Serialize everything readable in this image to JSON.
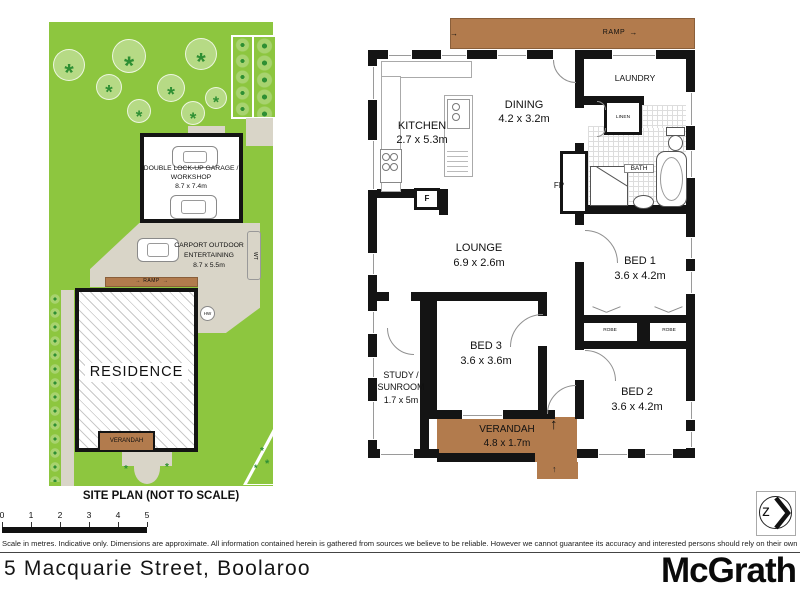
{
  "site_plan": {
    "title": "SITE PLAN (NOT TO SCALE)",
    "garage_label_1": "DOUBLE LOCK-UP GARAGE /",
    "garage_label_2": "WORKSHOP",
    "garage_dims": "8.7 x 7.4m",
    "carport_label_1": "CARPORT OUTDOOR",
    "carport_label_2": "ENTERTAINING",
    "carport_dims": "8.7 x 5.5m",
    "residence": "RESIDENCE",
    "verandah": "VERANDAH",
    "ramp": "RAMP",
    "water_tank": "WT",
    "hot_water": "HW"
  },
  "floor_plan": {
    "ramp": "RAMP",
    "kitchen_name": "KITCHEN",
    "kitchen_dims": "2.7 x 5.3m",
    "dining_name": "DINING",
    "dining_dims": "4.2 x 3.2m",
    "laundry": "LAUNDRY",
    "linen": "LINEN",
    "bath": "BATH",
    "fireplace": "FP",
    "fridge": "F",
    "lounge_name": "LOUNGE",
    "lounge_dims": "6.9 x 2.6m",
    "bed1_name": "BED 1",
    "bed1_dims": "3.6 x 4.2m",
    "bed2_name": "BED 2",
    "bed2_dims": "3.6 x 4.2m",
    "bed3_name": "BED 3",
    "bed3_dims": "3.6 x 3.6m",
    "study_line1": "STUDY /",
    "study_line2": "SUNROOM",
    "study_dims": "1.7 x 5m",
    "robe_left": "ROBE",
    "robe_right": "ROBE",
    "verandah_name": "VERANDAH",
    "verandah_dims": "4.8 x 1.7m"
  },
  "icons": {
    "arrow_right": "→",
    "arrow_up": "↑",
    "compass_letter": "z"
  },
  "footer": {
    "scale_ticks": [
      "0",
      "1",
      "2",
      "3",
      "4",
      "5"
    ],
    "disclaimer": "Scale in metres. Indicative only. Dimensions are approximate. All information contained herein is gathered from sources we believe to be reliable. However we cannot guarantee its accuracy and interested persons should rely on their own enquiries",
    "address": "5 Macquarie Street, Boolaroo",
    "brand": "McGrath"
  },
  "colors": {
    "lawn": "#8dc63f",
    "timber": "#b27b4d",
    "paving": "#d9d5c8",
    "wall": "#141414",
    "tree_fill": "#b6da85",
    "tree_leaf": "#2e8f33"
  }
}
